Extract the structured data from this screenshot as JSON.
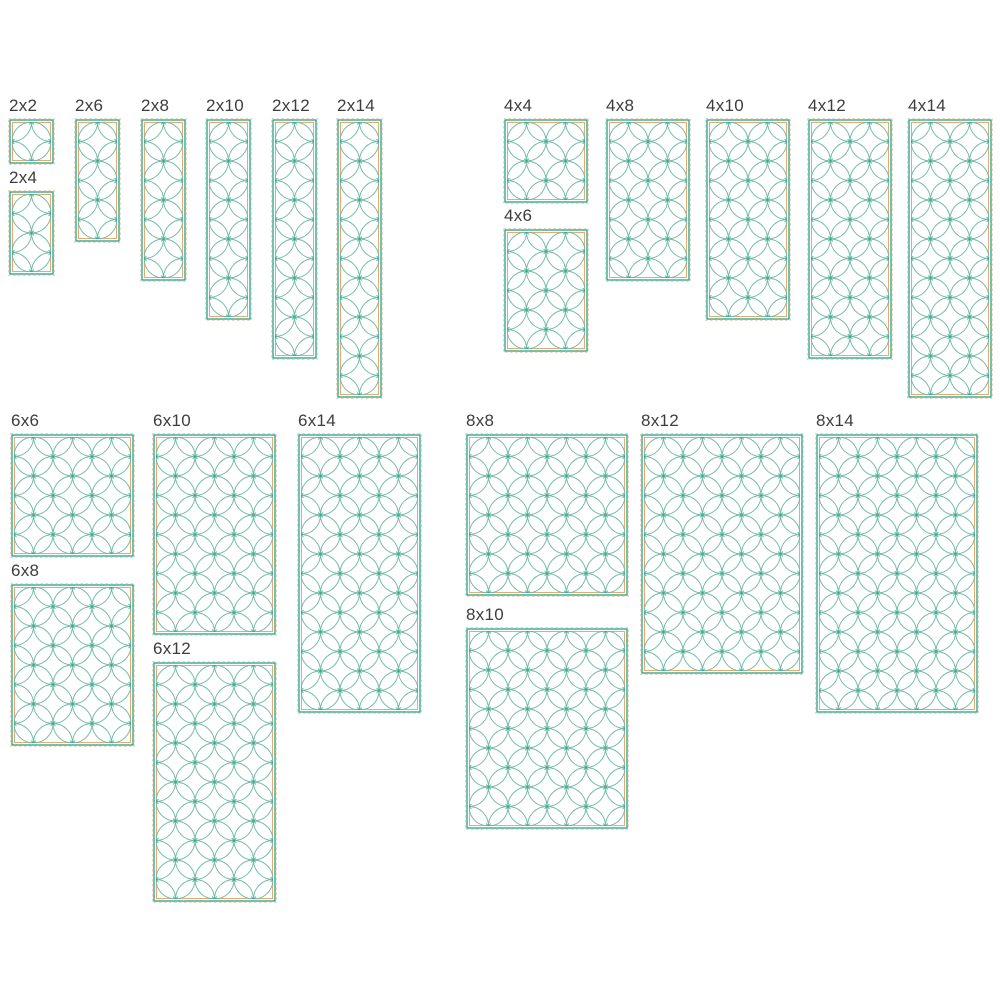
{
  "page": {
    "background": "#ffffff",
    "description": "Orange-peel quilting pattern size chart"
  },
  "pattern": {
    "motif": "orange-peel-interlocking-circles",
    "unit_px": 19.5,
    "tile_px": 39,
    "swatch_padding_px": 4,
    "label_height_px": 24,
    "line_color": "#6fb9a6",
    "node_color": "#2fa183",
    "stitch_border_color": "#2aa083",
    "fabric_border_color": "#e6a973",
    "bounds_dash_color": "#e4d7c6",
    "label_color": "#3d3d3d"
  },
  "groups": [
    {
      "name": "2-inch widths",
      "swatches": [
        {
          "label": "2x2",
          "cols": 2,
          "rows": 2,
          "x": 8,
          "y": 118
        },
        {
          "label": "2x4",
          "cols": 2,
          "rows": 4,
          "x": 8,
          "y": 190
        },
        {
          "label": "2x6",
          "cols": 2,
          "rows": 6,
          "x": 74,
          "y": 118
        },
        {
          "label": "2x8",
          "cols": 2,
          "rows": 8,
          "x": 140,
          "y": 118
        },
        {
          "label": "2x10",
          "cols": 2,
          "rows": 10,
          "x": 205,
          "y": 118
        },
        {
          "label": "2x12",
          "cols": 2,
          "rows": 12,
          "x": 271,
          "y": 118
        },
        {
          "label": "2x14",
          "cols": 2,
          "rows": 14,
          "x": 336,
          "y": 118
        }
      ]
    },
    {
      "name": "4-inch widths",
      "swatches": [
        {
          "label": "4x4",
          "cols": 4,
          "rows": 4,
          "x": 503,
          "y": 118
        },
        {
          "label": "4x6",
          "cols": 4,
          "rows": 6,
          "x": 503,
          "y": 228
        },
        {
          "label": "4x8",
          "cols": 4,
          "rows": 8,
          "x": 605,
          "y": 118
        },
        {
          "label": "4x10",
          "cols": 4,
          "rows": 10,
          "x": 705,
          "y": 118
        },
        {
          "label": "4x12",
          "cols": 4,
          "rows": 12,
          "x": 807,
          "y": 118
        },
        {
          "label": "4x14",
          "cols": 4,
          "rows": 14,
          "x": 907,
          "y": 118
        }
      ]
    },
    {
      "name": "6-inch widths",
      "swatches": [
        {
          "label": "6x6",
          "cols": 6,
          "rows": 6,
          "x": 10,
          "y": 433
        },
        {
          "label": "6x8",
          "cols": 6,
          "rows": 8,
          "x": 10,
          "y": 583
        },
        {
          "label": "6x10",
          "cols": 6,
          "rows": 10,
          "x": 152,
          "y": 433
        },
        {
          "label": "6x12",
          "cols": 6,
          "rows": 12,
          "x": 152,
          "y": 661
        },
        {
          "label": "6x14",
          "cols": 6,
          "rows": 14,
          "x": 297,
          "y": 433
        }
      ]
    },
    {
      "name": "8-inch widths",
      "swatches": [
        {
          "label": "8x8",
          "cols": 8,
          "rows": 8,
          "x": 465,
          "y": 433
        },
        {
          "label": "8x10",
          "cols": 8,
          "rows": 10,
          "x": 465,
          "y": 627
        },
        {
          "label": "8x12",
          "cols": 8,
          "rows": 12,
          "x": 640,
          "y": 433
        },
        {
          "label": "8x14",
          "cols": 8,
          "rows": 14,
          "x": 815,
          "y": 433
        }
      ]
    }
  ]
}
